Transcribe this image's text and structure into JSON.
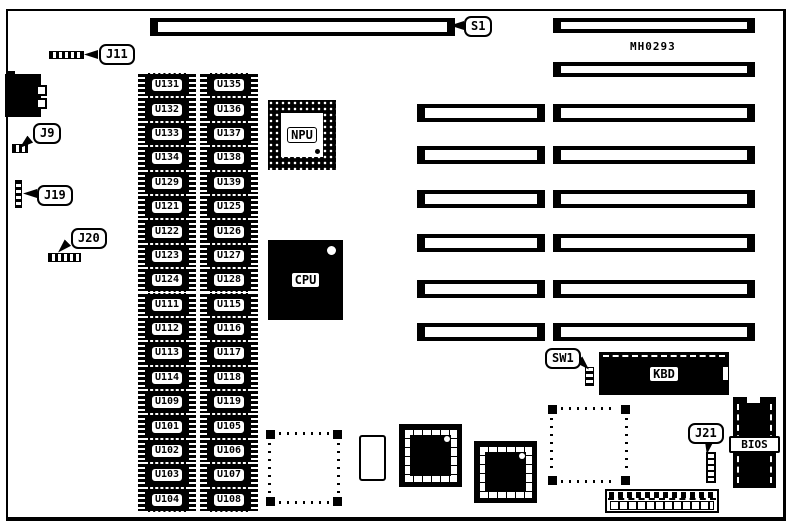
{
  "board": {
    "model_text": "MH0293",
    "callouts": {
      "s1": "S1",
      "j11": "J11",
      "j9": "J9",
      "j19": "J19",
      "j20": "J20",
      "sw1": "SW1",
      "j21": "J21"
    },
    "chips": {
      "npu": "NPU",
      "cpu": "CPU",
      "kbd": "KBD",
      "bios": "BIOS"
    },
    "memory": {
      "column1": [
        "U131",
        "U132",
        "U133",
        "U134",
        "U129",
        "U121",
        "U122",
        "U123",
        "U124",
        "U111",
        "U112",
        "U113",
        "U114",
        "U109",
        "U101",
        "U102",
        "U103",
        "U104"
      ],
      "column2": [
        "U135",
        "U136",
        "U137",
        "U138",
        "U139",
        "U125",
        "U126",
        "U127",
        "U128",
        "U115",
        "U116",
        "U117",
        "U118",
        "U119",
        "U105",
        "U106",
        "U107",
        "U108"
      ]
    },
    "expansion_slots": {
      "full_width_rows": 2,
      "split_rows": 6
    },
    "colors": {
      "ink": "#000000",
      "paper": "#ffffff"
    }
  }
}
